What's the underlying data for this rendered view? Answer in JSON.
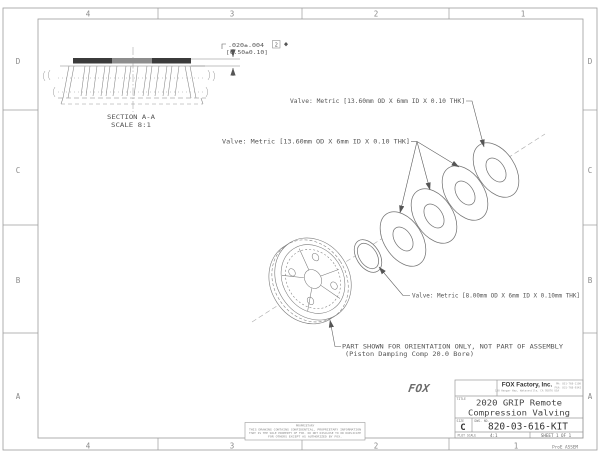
{
  "zones": {
    "top": [
      "4",
      "3",
      "2",
      "1"
    ],
    "bottom": [
      "4",
      "3",
      "2",
      "1"
    ],
    "left": [
      "D",
      "C",
      "B",
      "A"
    ],
    "right": [
      "D",
      "C",
      "B",
      "A"
    ]
  },
  "section_view": {
    "label_line1": "SECTION  A-A",
    "label_line2": "SCALE  8:1",
    "dim_inch": ".020±.004",
    "dim_mm": "[0.50±0.10]",
    "flag_note": "2"
  },
  "callouts": {
    "valve_top": "Valve: Metric [13.60mm OD X 6mm ID X 0.10 THK]",
    "valve_mid": "Valve: Metric [13.60mm OD X 6mm ID X 0.10 THK]",
    "valve_small": "Valve: Metric [8.00mm OD X 6mm ID X 0.10mm THK]",
    "orientation_line1": "PART SHOWN FOR ORIENTATION ONLY, NOT PART OF ASSEMBLY",
    "orientation_line2": "(Piston Damping Comp 20.0 Bore)"
  },
  "title_block": {
    "logo": "FOX",
    "company": "FOX Factory, Inc.",
    "address": "130 Hangar Way, Watsonville, CA 95076 USA",
    "phone": "PH: 831-768-1100",
    "fax": "FAX: 831-768-9342",
    "title_label": "TITLE",
    "title_line1": "2020 GRIP Remote",
    "title_line2": "Compression Valving",
    "size_label": "SIZE",
    "size_value": "C",
    "dwg_label": "DWG. NO.",
    "dwg_no": "820-03-616-KIT",
    "plot_scale_label": "PLOT SCALE",
    "plot_scale_value": "4:1",
    "sheet_value": "SHEET 1 OF 1",
    "footer_note": "ProE ASSEM"
  },
  "proprietary": {
    "heading": "PROPRIETARY",
    "line1": "THIS DRAWING CONTAINS CONFIDENTIAL, PROPRIETARY INFORMATION",
    "line2": "THAT IS THE SOLE PROPERTY OF FOX. DO NOT DISCLOSE TO OR DUPLICATE",
    "line3": "FOR OTHERS EXCEPT AS AUTHORIZED BY FOX."
  }
}
